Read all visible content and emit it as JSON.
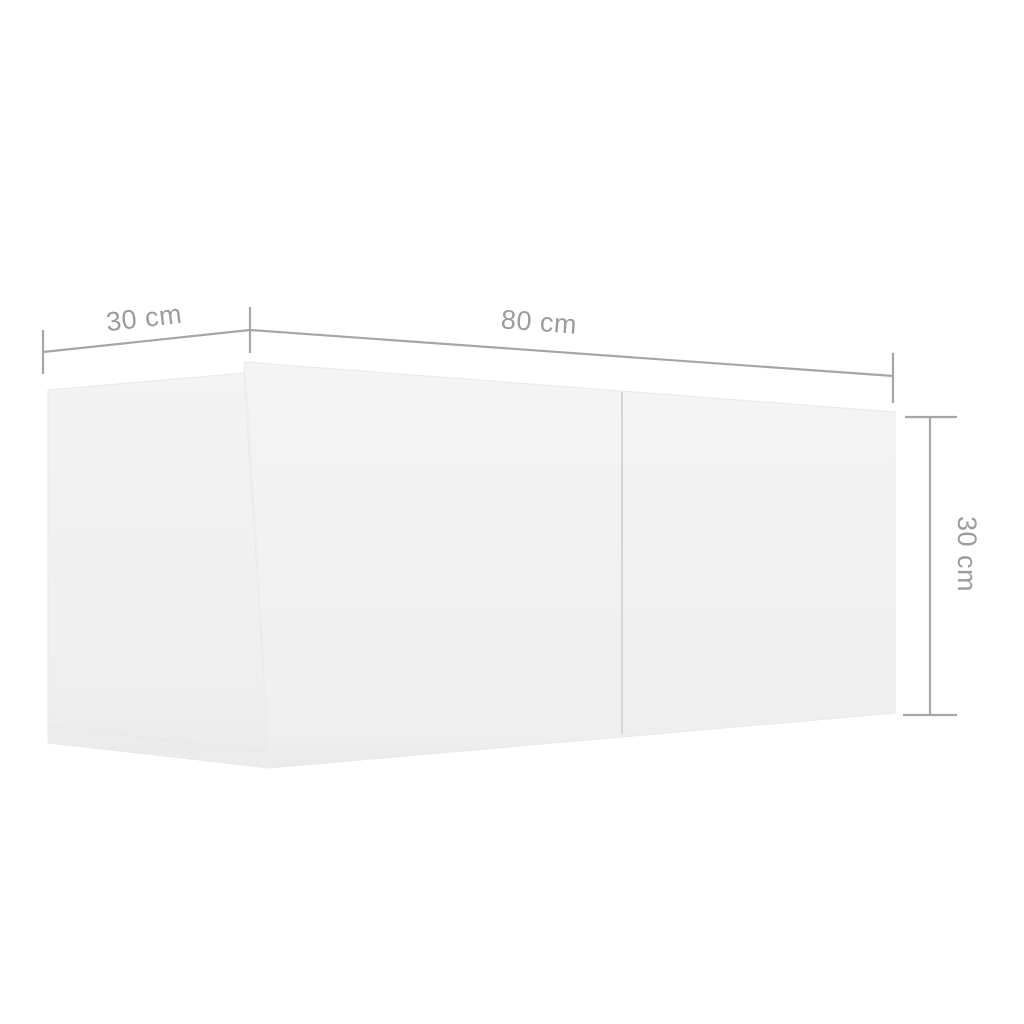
{
  "diagram": {
    "kind": "furniture-dimension-diagram",
    "object": "white wall-mounted tv cabinet, two sections, 3d perspective view",
    "labels": {
      "depth": "30 cm",
      "width": "80 cm",
      "height": "30 cm"
    },
    "values": {
      "depth_cm": 30,
      "width_cm": 80,
      "height_cm": 30,
      "unit": "cm"
    },
    "colors": {
      "background": "#ffffff",
      "dimension_line": "#a6a6a6",
      "label_text": "#9c9c9c",
      "cabinet_face": "#f2f2f2",
      "cabinet_side": "#f0f0f0",
      "door_seam": "#d6d6d6"
    }
  }
}
